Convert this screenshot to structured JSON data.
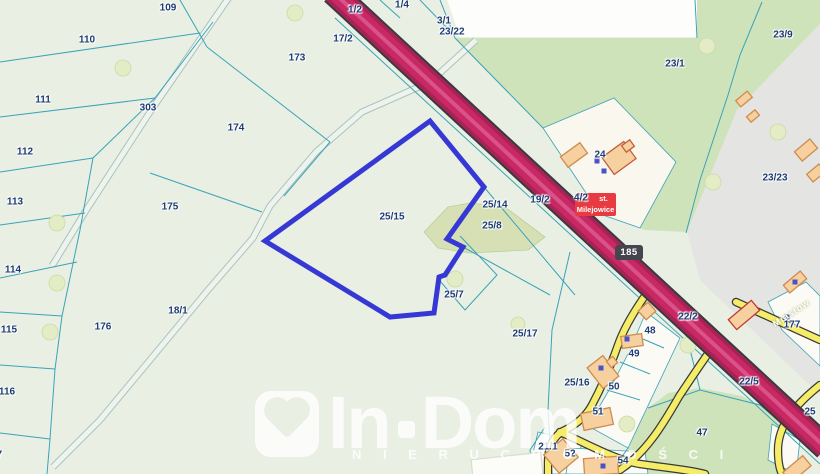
{
  "map": {
    "type": "cadastral-map",
    "highlighted_parcel": "25/15",
    "road_badge": "185",
    "locality_badge": {
      "line1": "st.",
      "line2": "Milejowice"
    },
    "street_label": "Miastow",
    "labels": [
      {
        "t": "109",
        "x": 168,
        "y": 8
      },
      {
        "t": "110",
        "x": 87,
        "y": 40
      },
      {
        "t": "111",
        "x": 43,
        "y": 100
      },
      {
        "t": "112",
        "x": 25,
        "y": 152
      },
      {
        "t": "113",
        "x": 15,
        "y": 202
      },
      {
        "t": "114",
        "x": 13,
        "y": 270
      },
      {
        "t": "115",
        "x": 9,
        "y": 330
      },
      {
        "t": "116",
        "x": 7,
        "y": 392
      },
      {
        "t": "117",
        "x": -6,
        "y": 455
      },
      {
        "t": "303",
        "x": 148,
        "y": 108
      },
      {
        "t": "173",
        "x": 297,
        "y": 58
      },
      {
        "t": "174",
        "x": 236,
        "y": 128
      },
      {
        "t": "175",
        "x": 170,
        "y": 207
      },
      {
        "t": "176",
        "x": 103,
        "y": 327
      },
      {
        "t": "18/1",
        "x": 178,
        "y": 311
      },
      {
        "t": "1/2",
        "x": 355,
        "y": 10
      },
      {
        "t": "1/4",
        "x": 402,
        "y": 5
      },
      {
        "t": "17/2",
        "x": 343,
        "y": 39
      },
      {
        "t": "3/1",
        "x": 444,
        "y": 21
      },
      {
        "t": "23/22",
        "x": 452,
        "y": 32
      },
      {
        "t": "23/1",
        "x": 675,
        "y": 64
      },
      {
        "t": "23/9",
        "x": 783,
        "y": 35
      },
      {
        "t": "23/23",
        "x": 775,
        "y": 178
      },
      {
        "t": "24",
        "x": 600,
        "y": 155
      },
      {
        "t": "19/2",
        "x": 540,
        "y": 200
      },
      {
        "t": "4/2",
        "x": 581,
        "y": 198
      },
      {
        "t": "25/14",
        "x": 495,
        "y": 205
      },
      {
        "t": "25/8",
        "x": 492,
        "y": 226
      },
      {
        "t": "25/15",
        "x": 392,
        "y": 217
      },
      {
        "t": "25/7",
        "x": 454,
        "y": 295
      },
      {
        "t": "25/17",
        "x": 525,
        "y": 334
      },
      {
        "t": "25/16",
        "x": 577,
        "y": 383
      },
      {
        "t": "22/2",
        "x": 688,
        "y": 317
      },
      {
        "t": "22/5",
        "x": 749,
        "y": 382
      },
      {
        "t": "48",
        "x": 650,
        "y": 331
      },
      {
        "t": "49",
        "x": 634,
        "y": 354
      },
      {
        "t": "50",
        "x": 614,
        "y": 387
      },
      {
        "t": "51",
        "x": 598,
        "y": 412
      },
      {
        "t": "52",
        "x": 570,
        "y": 454
      },
      {
        "t": "54",
        "x": 623,
        "y": 461
      },
      {
        "t": "21/1",
        "x": 548,
        "y": 447
      },
      {
        "t": "47",
        "x": 702,
        "y": 433
      },
      {
        "t": "177",
        "x": 792,
        "y": 325
      },
      {
        "t": "43",
        "x": 270,
        "y": 407
      },
      {
        "t": "25",
        "x": 810,
        "y": 412
      }
    ],
    "colors": {
      "background": "#e9efe3",
      "vegetation_green": "#cfe3bb",
      "built_gray": "#e4e4e2",
      "parcel_line": "#3aa3b8",
      "label_text": "#1d3c74",
      "main_road": "#c62a66",
      "local_road": "#f5ec67",
      "building_fill": "#f6d09e",
      "highlight_outline": "#3538d4",
      "locality_badge_bg": "#e73b41",
      "road_badge_bg": "#45454d"
    }
  },
  "watermark": {
    "brand_left": "In",
    "brand_right": "Dom",
    "subtitle": "N I E R U C H O M O Ś C I"
  }
}
